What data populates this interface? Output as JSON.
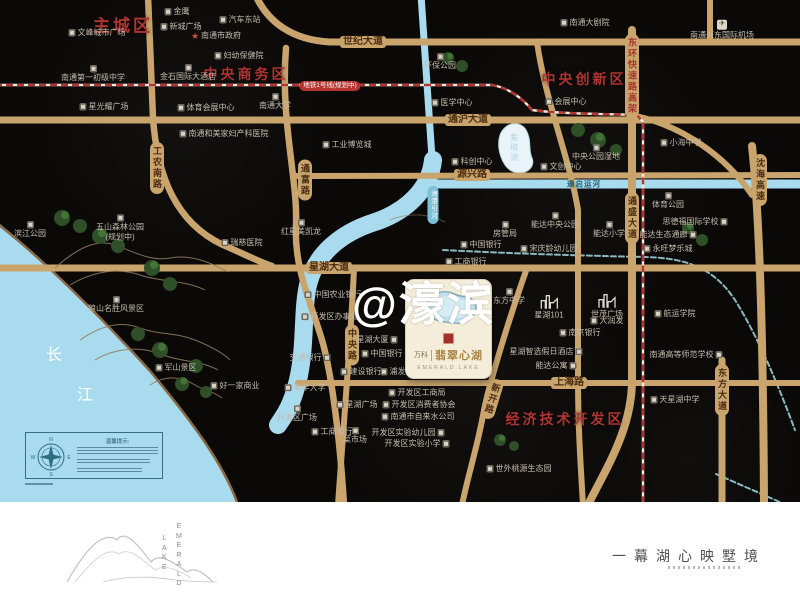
{
  "watermark": "@濠滨",
  "colors": {
    "road": "#c9a46c",
    "water": "#a9dbee",
    "metro_red": "#b5342f",
    "district_red": "#b03430",
    "card_bg": "#f4edda",
    "brand_gold": "#a98545"
  },
  "map": {
    "districts": [
      {
        "label": "主城区",
        "x": 123,
        "y": 24,
        "fs": 17
      },
      {
        "label": "中央商务区",
        "x": 246,
        "y": 74,
        "fs": 14
      },
      {
        "label": "中央创新区",
        "x": 584,
        "y": 79,
        "fs": 14
      },
      {
        "label": "经济技术开发区",
        "x": 565,
        "y": 419,
        "fs": 14
      }
    ],
    "road_labels": [
      {
        "label": "世纪大道",
        "x": 363,
        "y": 42,
        "style": "h"
      },
      {
        "label": "通沪大道",
        "x": 468,
        "y": 120,
        "style": "h"
      },
      {
        "label": "源兴路",
        "x": 472,
        "y": 175,
        "style": "h"
      },
      {
        "label": "星湖大道",
        "x": 329,
        "y": 268,
        "style": "h"
      },
      {
        "label": "上海路",
        "x": 569,
        "y": 383,
        "style": "h"
      },
      {
        "label": "工农南路",
        "x": 157,
        "y": 168,
        "style": "v"
      },
      {
        "label": "通富路",
        "x": 305,
        "y": 180,
        "style": "v"
      },
      {
        "label": "中央路",
        "x": 352,
        "y": 345,
        "style": "v"
      },
      {
        "label": "通盛大道",
        "x": 632,
        "y": 218,
        "style": "v"
      },
      {
        "label": "东方大道",
        "x": 722,
        "y": 390,
        "style": "v"
      },
      {
        "label": "沈海高速",
        "x": 760,
        "y": 180,
        "style": "v"
      },
      {
        "label": "新开路",
        "x": 492,
        "y": 399,
        "style": "v",
        "rot": 17
      },
      {
        "label": "东环快速路高架",
        "x": 632,
        "y": 76,
        "style": "vred"
      },
      {
        "label": "地铁1号线(规划中)",
        "x": 330,
        "y": 86,
        "style": "metro"
      },
      {
        "label": "海港引河",
        "x": 433,
        "y": 205,
        "style": "river"
      },
      {
        "label": "紫琅湖",
        "x": 514,
        "y": 148,
        "style": "lakename"
      },
      {
        "label": "通启运河",
        "x": 584,
        "y": 184,
        "style": "canal"
      },
      {
        "label": "长",
        "x": 55,
        "y": 353,
        "style": "sea"
      },
      {
        "label": "江",
        "x": 86,
        "y": 393,
        "style": "sea"
      }
    ],
    "pois": [
      {
        "label": "金鹰",
        "x": 177,
        "y": 12,
        "icon": "box",
        "ipos": "left"
      },
      {
        "label": "汽车东站",
        "x": 240,
        "y": 20,
        "icon": "box",
        "ipos": "left"
      },
      {
        "label": "新城广场",
        "x": 181,
        "y": 27,
        "icon": "box",
        "ipos": "left"
      },
      {
        "label": "文峰城市广场",
        "x": 97,
        "y": 33,
        "icon": "box",
        "ipos": "left"
      },
      {
        "label": "南通市政府",
        "x": 216,
        "y": 36,
        "icon": "star",
        "ipos": "left"
      },
      {
        "label": "妇幼保健院",
        "x": 239,
        "y": 56,
        "icon": "box",
        "ipos": "left"
      },
      {
        "label": "南通第一初级中学",
        "x": 93,
        "y": 74,
        "icon": "box",
        "ipos": "above"
      },
      {
        "label": "金石国际大酒店",
        "x": 188,
        "y": 73,
        "icon": "box",
        "ipos": "above"
      },
      {
        "label": "南通大学",
        "x": 275,
        "y": 102,
        "icon": "box",
        "ipos": "above"
      },
      {
        "label": "星光耀广场",
        "x": 104,
        "y": 107,
        "icon": "box",
        "ipos": "left"
      },
      {
        "label": "体育会展中心",
        "x": 206,
        "y": 108,
        "icon": "box",
        "ipos": "left"
      },
      {
        "label": "南通和美家妇产科医院",
        "x": 224,
        "y": 134,
        "icon": "box",
        "ipos": "left"
      },
      {
        "label": "环保公园",
        "x": 440,
        "y": 62,
        "icon": "box",
        "ipos": "above"
      },
      {
        "label": "医学中心",
        "x": 452,
        "y": 103,
        "icon": "box",
        "ipos": "left"
      },
      {
        "label": "工业博览城",
        "x": 347,
        "y": 145,
        "icon": "box",
        "ipos": "left"
      },
      {
        "label": "科创中心",
        "x": 472,
        "y": 162,
        "icon": "box",
        "ipos": "left"
      },
      {
        "label": "南通大剧院",
        "x": 585,
        "y": 23,
        "icon": "box",
        "ipos": "left"
      },
      {
        "label": "南通兴东国际机场",
        "x": 722,
        "y": 30,
        "icon": "plane",
        "ipos": "above"
      },
      {
        "label": "会展中心",
        "x": 566,
        "y": 102,
        "icon": "box",
        "ipos": "left"
      },
      {
        "label": "中央公园湿地",
        "x": 596,
        "y": 153,
        "icon": "box",
        "ipos": "above"
      },
      {
        "label": "文创中心",
        "x": 561,
        "y": 167,
        "icon": "box",
        "ipos": "left"
      },
      {
        "label": "小海中学",
        "x": 681,
        "y": 143,
        "icon": "box",
        "ipos": "left"
      },
      {
        "label": "滨江公园",
        "x": 30,
        "y": 230,
        "icon": "box",
        "ipos": "above"
      },
      {
        "label": "五山森林公园\n(规划中)",
        "x": 120,
        "y": 228,
        "icon": "box",
        "ipos": "above"
      },
      {
        "label": "瑞慈医院",
        "x": 242,
        "y": 243,
        "icon": "box",
        "ipos": "left"
      },
      {
        "label": "红星美凯龙",
        "x": 301,
        "y": 228,
        "icon": "box",
        "ipos": "above"
      },
      {
        "label": "狼山名胜风景区",
        "x": 116,
        "y": 305,
        "icon": "box",
        "ipos": "above"
      },
      {
        "label": "军山景区",
        "x": 176,
        "y": 368,
        "icon": "box",
        "ipos": "left"
      },
      {
        "label": "好一家商业",
        "x": 235,
        "y": 386,
        "icon": "box",
        "ipos": "left"
      },
      {
        "label": "中国农业银行",
        "x": 333,
        "y": 295,
        "icon": "box",
        "ipos": "left"
      },
      {
        "label": "开发区办事处",
        "x": 330,
        "y": 317,
        "icon": "box",
        "ipos": "left"
      },
      {
        "label": "星湖大厦",
        "x": 377,
        "y": 340,
        "icon": "box",
        "ipos": "right"
      },
      {
        "label": "中国银行",
        "x": 382,
        "y": 354,
        "icon": "box",
        "ipos": "left"
      },
      {
        "label": "交通银行",
        "x": 310,
        "y": 358,
        "icon": "box",
        "ipos": "right"
      },
      {
        "label": "建设银行",
        "x": 361,
        "y": 372,
        "icon": "box",
        "ipos": "left"
      },
      {
        "label": "浦发银行",
        "x": 401,
        "y": 372,
        "icon": "box",
        "ipos": "left"
      },
      {
        "label": "房管局",
        "x": 505,
        "y": 230,
        "icon": "box",
        "ipos": "above"
      },
      {
        "label": "中国银行",
        "x": 481,
        "y": 245,
        "icon": "box",
        "ipos": "left"
      },
      {
        "label": "工商银行",
        "x": 466,
        "y": 262,
        "icon": "box",
        "ipos": "left"
      },
      {
        "label": "东方中学",
        "x": 509,
        "y": 297,
        "icon": "box",
        "ipos": "above"
      },
      {
        "label": "宋庆龄幼儿园",
        "x": 549,
        "y": 249,
        "icon": "box",
        "ipos": "left"
      },
      {
        "label": "能达中央公园",
        "x": 555,
        "y": 221,
        "icon": "box",
        "ipos": "above"
      },
      {
        "label": "能达小学",
        "x": 609,
        "y": 230,
        "icon": "box",
        "ipos": "above"
      },
      {
        "label": "体育公园",
        "x": 668,
        "y": 201,
        "icon": "box",
        "ipos": "above"
      },
      {
        "label": "思德福国际学校",
        "x": 695,
        "y": 222,
        "icon": "box",
        "ipos": "right"
      },
      {
        "label": "能达生态通廊",
        "x": 668,
        "y": 235,
        "icon": "box",
        "ipos": "right"
      },
      {
        "label": "永旺梦乐城",
        "x": 668,
        "y": 249,
        "icon": "box",
        "ipos": "left"
      },
      {
        "label": "星湖101",
        "x": 549,
        "y": 307,
        "icon": "building",
        "ipos": "above"
      },
      {
        "label": "世茂广场",
        "x": 607,
        "y": 306,
        "icon": "building",
        "ipos": "above"
      },
      {
        "label": "大润发",
        "x": 607,
        "y": 321,
        "icon": "box",
        "ipos": "left"
      },
      {
        "label": "南京银行",
        "x": 580,
        "y": 333,
        "icon": "box",
        "ipos": "left"
      },
      {
        "label": "星湖智选假日酒店",
        "x": 546,
        "y": 352,
        "icon": "box",
        "ipos": "right"
      },
      {
        "label": "能达公寓",
        "x": 556,
        "y": 366,
        "icon": "box",
        "ipos": "right"
      },
      {
        "label": "航运学院",
        "x": 675,
        "y": 314,
        "icon": "box",
        "ipos": "left"
      },
      {
        "label": "南通高等师范学校",
        "x": 686,
        "y": 355,
        "icon": "box",
        "ipos": "right"
      },
      {
        "label": "天星湖中学",
        "x": 675,
        "y": 400,
        "icon": "box",
        "ipos": "left"
      },
      {
        "label": "老年大学",
        "x": 305,
        "y": 388,
        "icon": "box",
        "ipos": "left"
      },
      {
        "label": "开发区广场",
        "x": 297,
        "y": 414,
        "icon": "box",
        "ipos": "above"
      },
      {
        "label": "星湖广场",
        "x": 357,
        "y": 405,
        "icon": "box",
        "ipos": "left"
      },
      {
        "label": "菜市场",
        "x": 355,
        "y": 436,
        "icon": "box",
        "ipos": "above"
      },
      {
        "label": "工商银行",
        "x": 332,
        "y": 432,
        "icon": "box",
        "ipos": "left"
      },
      {
        "label": "开发区工商局",
        "x": 417,
        "y": 393,
        "icon": "box",
        "ipos": "left"
      },
      {
        "label": "开发区消费者协会",
        "x": 419,
        "y": 405,
        "icon": "box",
        "ipos": "left"
      },
      {
        "label": "南通市自来水公司",
        "x": 418,
        "y": 417,
        "icon": "box",
        "ipos": "left"
      },
      {
        "label": "开发区实验幼儿园",
        "x": 408,
        "y": 433,
        "icon": "box",
        "ipos": "right"
      },
      {
        "label": "开发区实验小学",
        "x": 417,
        "y": 444,
        "icon": "box",
        "ipos": "right"
      },
      {
        "label": "世外桃源生态园",
        "x": 519,
        "y": 469,
        "icon": "box",
        "ipos": "left"
      }
    ]
  },
  "card": {
    "brand_cn": "万科",
    "name_cn": "翡翠心湖",
    "name_en": "EMERALD LAKE"
  },
  "compass": {
    "title": "温馨提示:",
    "n": "N",
    "e": "E",
    "s": "S",
    "w": "W"
  },
  "footer": {
    "tagline": "一幕湖心映墅境",
    "logo_en_1": "EMERALD",
    "logo_en_2": "LAKE"
  }
}
